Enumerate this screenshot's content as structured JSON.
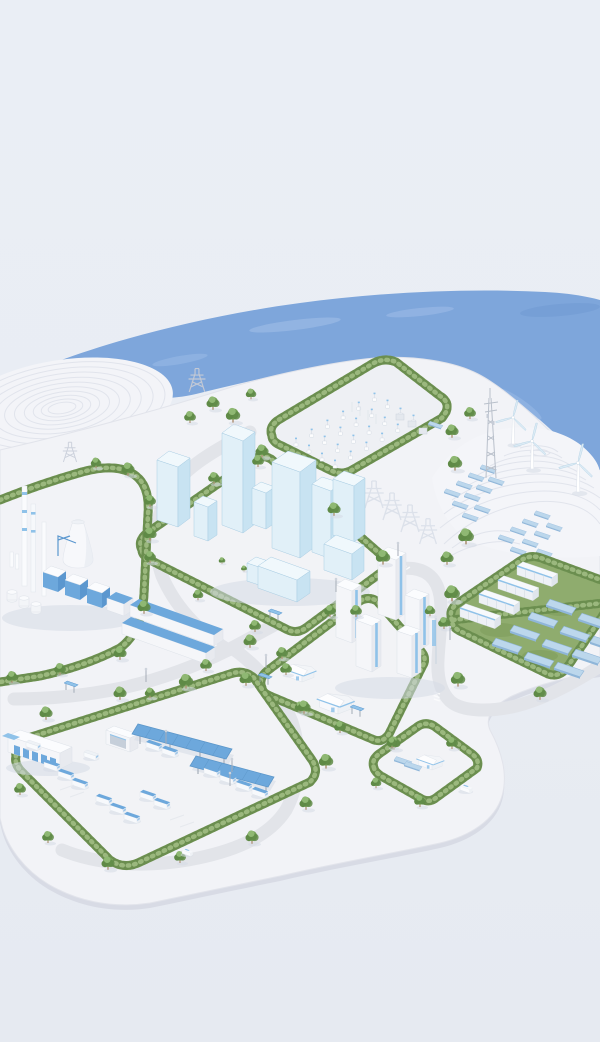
{
  "meta": {
    "description": "Isometric 3D miniature illustration of a coastal green-energy city: districts with glass towers, industry, housing, solar and battery yards, a logistics depot, wind turbines on terraced shore hills, hedgerow-lined roads and a blue sea."
  },
  "colors": {
    "background": "#eaeef5",
    "background_edge": "#e6eaf1",
    "water": "#7ea6db",
    "water_light": "#a6c2ea",
    "water_deep": "#6e97d2",
    "platform": "#f2f3f7",
    "platform_side": "#d8dbe5",
    "platform_line": "#e2e4eb",
    "road": "#e2e4e9",
    "mound": "#f3f4f8",
    "contour": "#e1e4ec",
    "hedge_dark": "#5f8044",
    "hedge_mid": "#7ba05e",
    "hedge_light": "#a3bf86",
    "grass": "#8fac6e",
    "grass_dark": "#74924f",
    "tree_dark": "#5f8a46",
    "tree_mid": "#74a058",
    "tree_light": "#8fb873",
    "trunk": "#b2977c",
    "glass_sw": "#e1f0f8",
    "glass_se": "#c8e3f2",
    "glass_top": "#f0f8fc",
    "glass_line": "#a9cde3",
    "white_sw": "#f5f6f9",
    "white_se": "#e8eaef",
    "white_top": "#fbfcfe",
    "accent": "#6da8dc",
    "accent_dark": "#5b97cf",
    "accent_light": "#8fc2e9",
    "panel": "#bcd7ec",
    "panel_edge": "#8fb6d9",
    "metal": "#b9c0cb",
    "shadow": "#d6dae6"
  },
  "scene": {
    "setting": "isometric miniature of a coastal eco-industrial city on a white island platform",
    "sea": {
      "position": "upper band, widening to the right"
    },
    "terraced_mound": {
      "position": "upper left shore",
      "contour_rings": 10
    },
    "wind_hill": {
      "position": "right shore",
      "wind_turbines": 3,
      "hillside_solar_panels": 20,
      "terraced": true
    },
    "masts": {
      "telecom_lattice_tower": 1,
      "transmission_pylons": 6
    },
    "districts": [
      {
        "id": "substation",
        "label": "switchyard / substation parcel",
        "position": "top center",
        "equipment_rows": 4,
        "transformer_boxes": 3,
        "solar_panels": 1
      },
      {
        "id": "downtown",
        "label": "glass-tower downtown block",
        "position": "center left",
        "glass_towers": 8,
        "podium_blocks": 2
      },
      {
        "id": "industrial",
        "label": "industrial plant",
        "position": "left edge",
        "cooling_towers": 1,
        "chimneys": 3,
        "factory_halls": 4,
        "long_warehouses": 2,
        "storage_tanks": 3
      },
      {
        "id": "residential",
        "label": "residential block",
        "position": "center",
        "apartment_towers": 5,
        "villas": 2
      },
      {
        "id": "energy_storage",
        "label": "solar + battery storage yard",
        "position": "right",
        "battery_containers": 4,
        "solar_panel_rows": 3,
        "solar_panels": 12
      },
      {
        "id": "logistics",
        "label": "logistics / vehicle depot",
        "position": "bottom left",
        "warehouses": 1,
        "garages": 1,
        "solar_canopies": 2,
        "parked_vehicles": 16
      },
      {
        "id": "small_lot",
        "label": "small house parcel",
        "position": "bottom right",
        "houses": 1,
        "solar_panels": 2
      }
    ],
    "roads": {
      "segments": 4,
      "crosswalks": 3,
      "street_lamps": 8,
      "bus_shelters": 4
    },
    "vehicles": {
      "cars_on_road": 2
    },
    "vegetation": {
      "trees": 55,
      "hedgerow_rings": 7
    }
  }
}
